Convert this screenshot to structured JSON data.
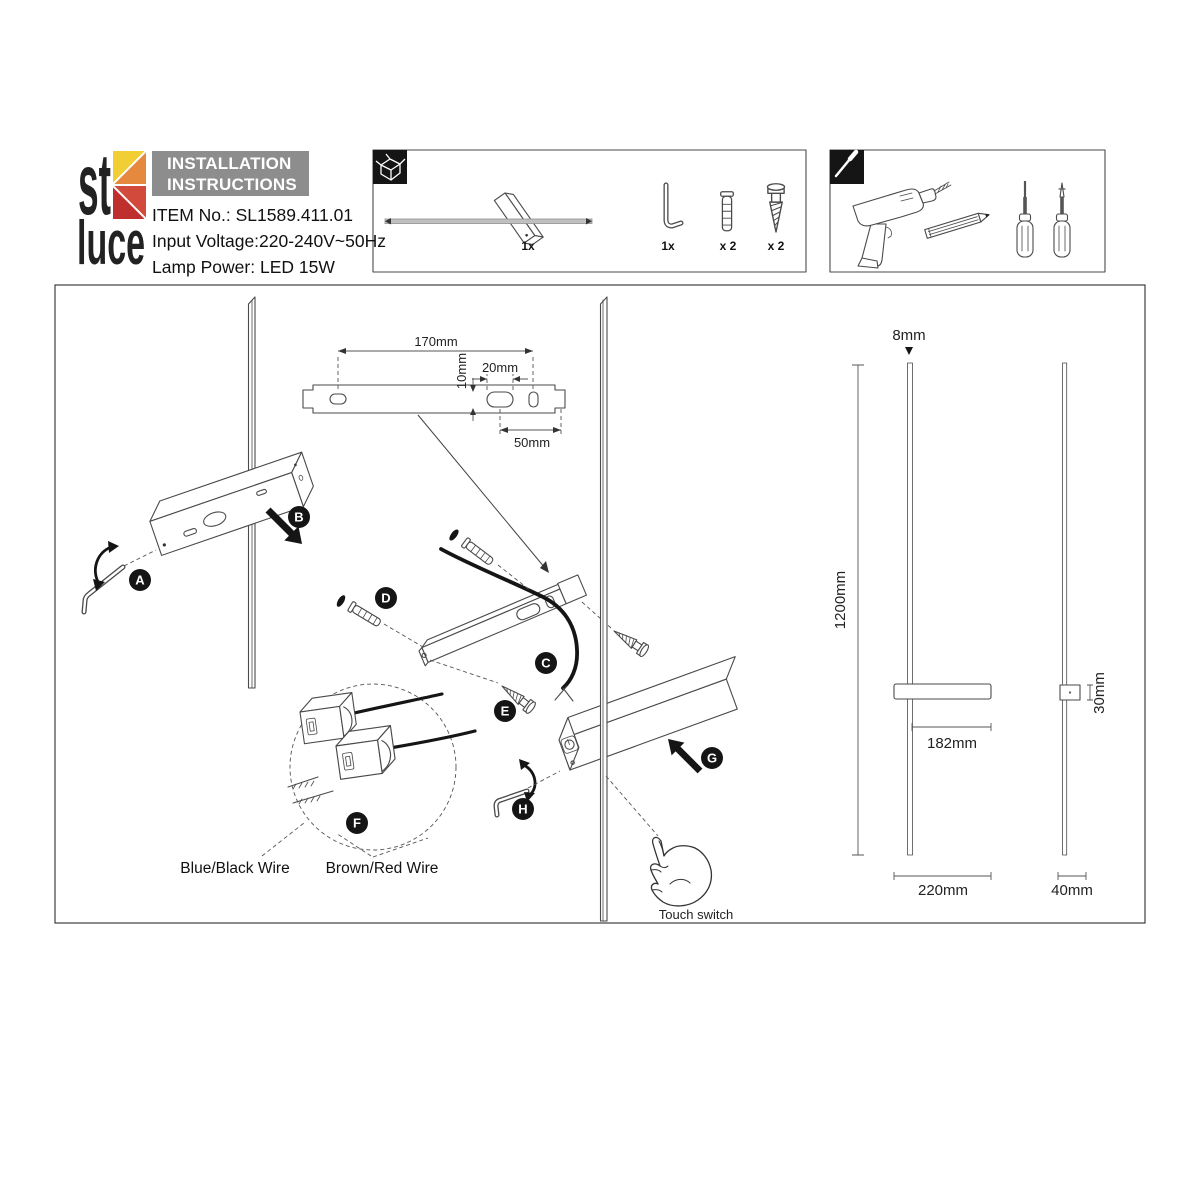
{
  "header": {
    "logo": {
      "st": "st",
      "luce": "luce",
      "colors": {
        "yellow": "#F2CE35",
        "orange": "#E5893E",
        "red_light": "#D14A3C",
        "red_dark": "#BE2F2E"
      }
    },
    "title_line1": "INSTALLATION",
    "title_line2": "INSTRUCTIONS",
    "item_no": "ITEM No.: SL1589.411.01",
    "input_voltage": "Input Voltage:220-240V~50Hz",
    "lamp_power": "Lamp Power: LED 15W"
  },
  "package_box": {
    "items": [
      {
        "name": "lamp-rod",
        "qty": "1x"
      },
      {
        "name": "hex-key",
        "qty": "1x"
      },
      {
        "name": "wall-plug",
        "qty": "x 2"
      },
      {
        "name": "screw",
        "qty": "x 2"
      }
    ]
  },
  "tools_box": {
    "tools": [
      "drill",
      "pencil",
      "slotted-screwdriver",
      "phillips-screwdriver"
    ]
  },
  "diagram": {
    "steps": {
      "a": "A",
      "b": "B",
      "c": "C",
      "d": "D",
      "e": "E",
      "f": "F",
      "g": "G",
      "h": "H"
    },
    "bracket": {
      "length": "170mm",
      "hole_height": "10mm",
      "slot_width": "20mm",
      "offset": "50mm"
    },
    "wires": {
      "blue_black": "Blue/Black Wire",
      "brown_red": "Brown/Red Wire"
    },
    "touch_switch": "Touch switch",
    "front_view": {
      "rod_diameter": "8mm",
      "height": "1200mm",
      "bracket_length": "182mm",
      "width": "220mm"
    },
    "side_view": {
      "depth": "30mm",
      "width": "40mm"
    }
  }
}
